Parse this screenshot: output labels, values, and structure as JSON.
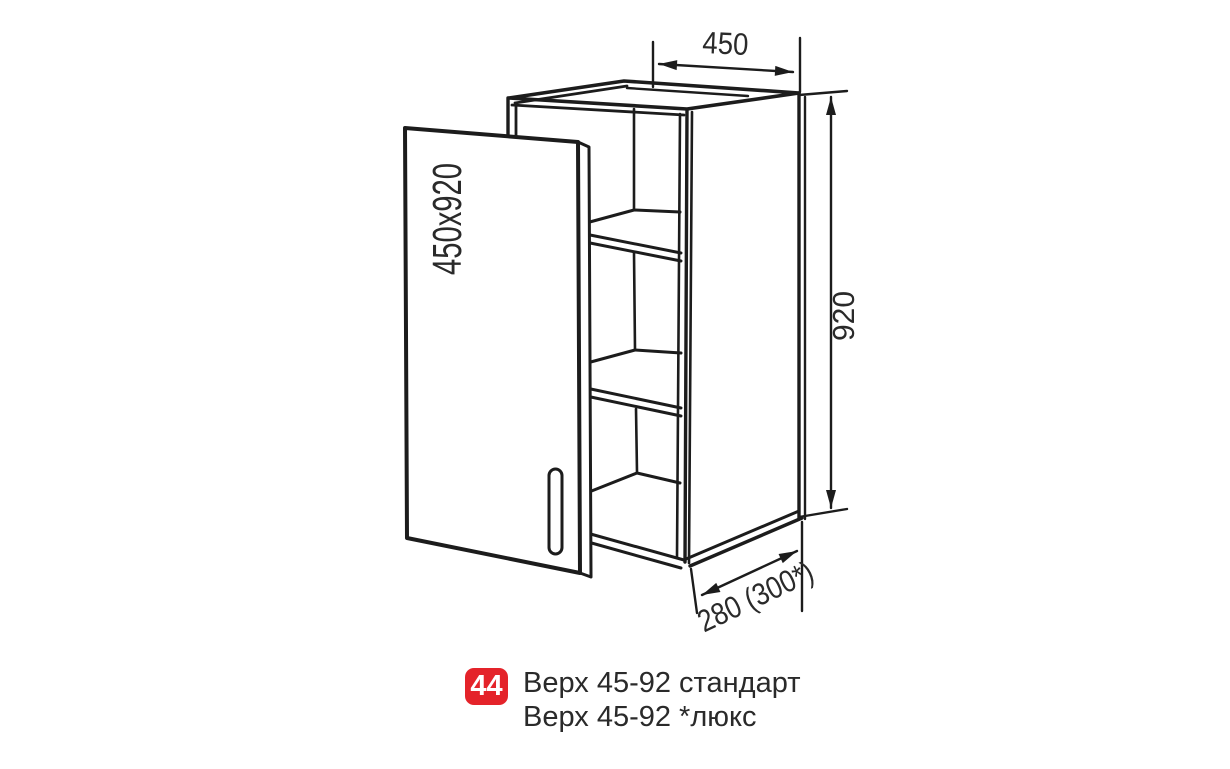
{
  "drawing": {
    "door_label": "450x920",
    "dim_width": "450",
    "dim_height": "920",
    "dim_depth": "280 (300*)"
  },
  "caption": {
    "badge": "44",
    "line1": "Верх 45-92 стандарт",
    "line2": "Верх 45-92 *люкс"
  },
  "colors": {
    "badge_red": "#e4232a",
    "line_color": "#1c1c1c",
    "text_color": "#2a2a2a"
  }
}
